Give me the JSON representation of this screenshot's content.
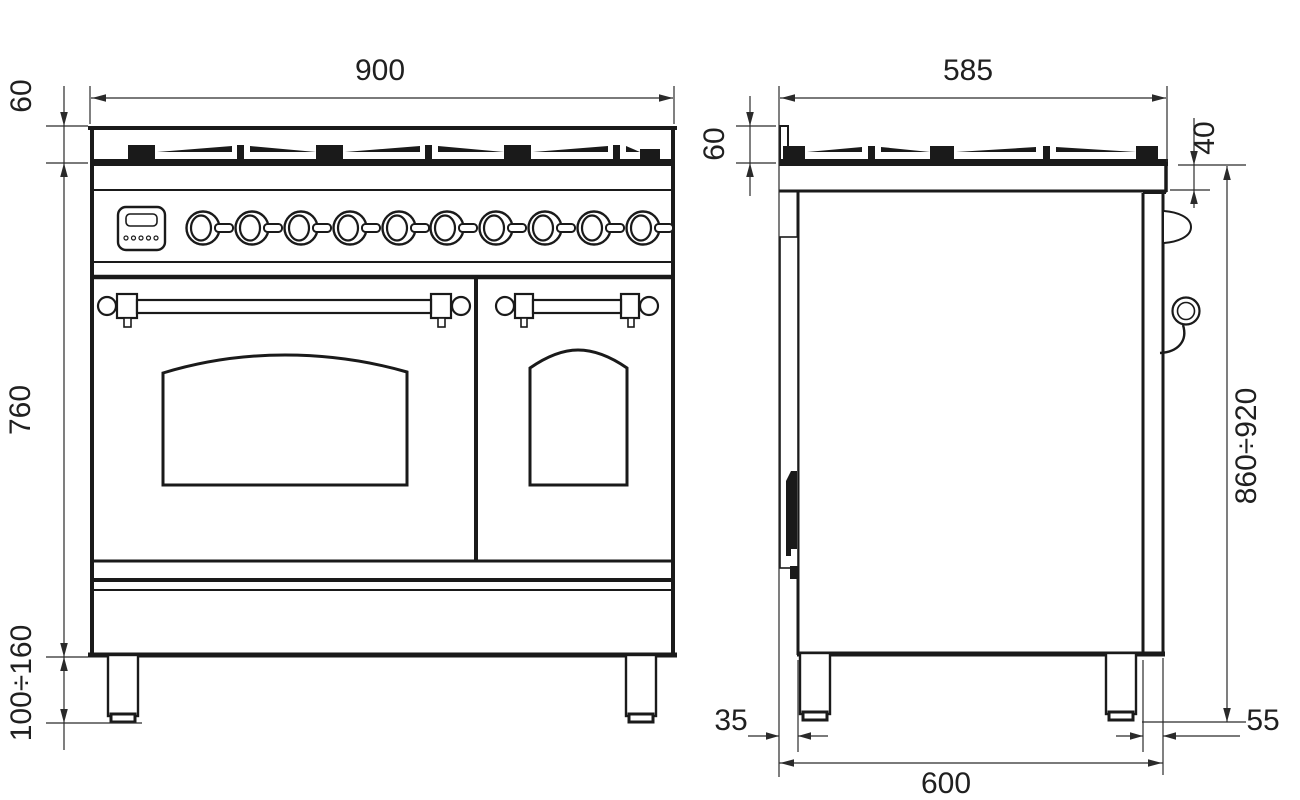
{
  "drawing": {
    "type": "range-cooker-dimension-diagram",
    "colors": {
      "line": "#1a1a1a",
      "background": "#ffffff"
    },
    "dims": {
      "front": {
        "width": "900",
        "top_height": "60",
        "body_height": "760",
        "leg_height": "100÷160"
      },
      "side": {
        "depth": "585",
        "top_height": "60",
        "worktop_edge": "40",
        "overall_height": "860÷920",
        "rear_offset": "35",
        "base_depth": "600",
        "front_offset": "55"
      }
    }
  }
}
